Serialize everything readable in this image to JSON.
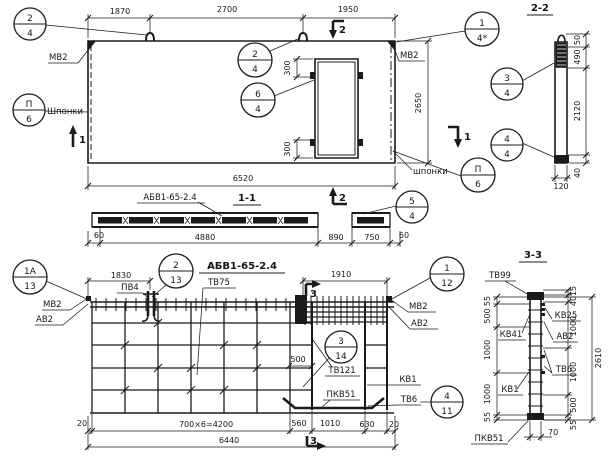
{
  "plan": {
    "dims": {
      "seg1": "1870",
      "seg2": "2700",
      "seg3": "1950",
      "total": "6520",
      "height": "2650",
      "door_top": "300",
      "door_bot": "300"
    },
    "labels": {
      "mv2_left": "МВ2",
      "mv2_right": "МВ2",
      "keys_left": "Шпонки",
      "keys_right": "шпонки"
    },
    "callouts": {
      "tl": {
        "top": "2",
        "bot": "4"
      },
      "hook": {
        "top": "2",
        "bot": "4"
      },
      "door": {
        "top": "6",
        "bot": "4"
      },
      "tr": {
        "top": "1",
        "bot": "4*"
      },
      "keys_l": {
        "top": "П",
        "bot": "6"
      },
      "keys_r": {
        "top": "П",
        "bot": "6"
      }
    },
    "marks": {
      "m1": "1",
      "m2": "2"
    }
  },
  "section11": {
    "title": "1-1",
    "product": "АБВ1-65-2.4",
    "mark": "2",
    "callout": {
      "top": "5",
      "bot": "4"
    },
    "dims": {
      "left_margin": "60",
      "body": "4880",
      "opening": "890",
      "pier": "750",
      "right_margin": "60"
    }
  },
  "section22": {
    "title": "2-2",
    "dims": {
      "top": "50",
      "anchor": "490",
      "body": "2120",
      "bottom": "40",
      "width": "120"
    },
    "callouts": {
      "upper": {
        "top": "3",
        "bot": "4"
      },
      "lower": {
        "top": "4",
        "bot": "4"
      }
    }
  },
  "reinforcement": {
    "title": "АБВ1-65-2.4",
    "mark": "3",
    "dims": {
      "left": "1830",
      "lintel": "1910",
      "inset": "500",
      "margin_l": "20",
      "spacing": "700×6=4200",
      "s1": "560",
      "s2": "1010",
      "s3": "630",
      "margin_r": "20",
      "total": "6440"
    },
    "labels": {
      "pv4": "ПВ4",
      "tv75": "ТВ75",
      "mv2_l": "МВ2",
      "av2_l": "АВ2",
      "mv2_r": "МВ2",
      "av2_r": "АВ2",
      "tv121": "ТВ121",
      "kv1": "КВ1",
      "pkv51": "ПКВ51",
      "tv6": "ТВ6"
    },
    "callouts": {
      "c1a": {
        "top": "1А",
        "bot": "13"
      },
      "c2": {
        "top": "2",
        "bot": "13"
      },
      "c1": {
        "top": "1",
        "bot": "12"
      },
      "c3": {
        "top": "3",
        "bot": "14"
      },
      "c4": {
        "top": "4",
        "bot": "11"
      }
    }
  },
  "section33": {
    "title": "3-3",
    "labels": {
      "tv99": "ТВ99",
      "kv25": "КВ25",
      "kv41": "КВ41",
      "av2": "АВ2",
      "tv6": "ТВ6",
      "kv1": "КВ1",
      "pkv51": "ПКВ51"
    },
    "dims_left": [
      "55",
      "500",
      "1000",
      "1000",
      "55"
    ],
    "dims_right": [
      "15",
      "40",
      "1000",
      "1000",
      "500",
      "55"
    ],
    "total": "2610",
    "width": "70"
  }
}
